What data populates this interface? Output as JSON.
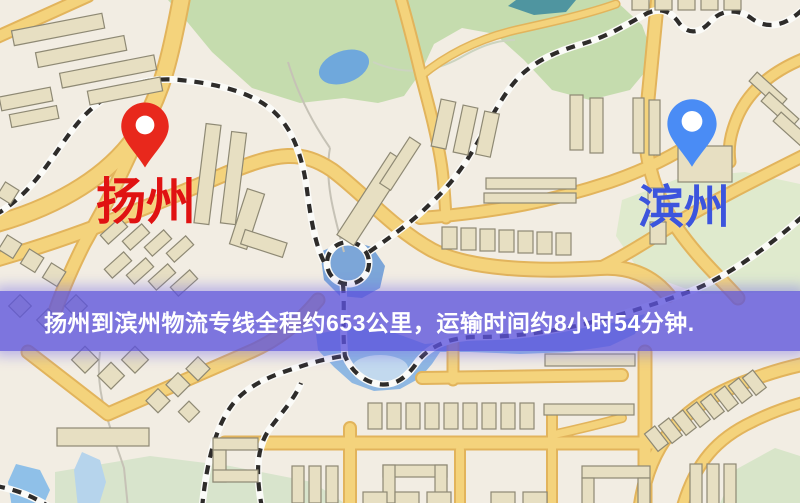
{
  "map": {
    "banner": {
      "text": "扬州到滨州物流专线全程约653公里，运输时间约8小时54分钟.",
      "background": "#5c53dd",
      "text_color": "#ffffff"
    },
    "markers": [
      {
        "id": "yangzhou",
        "label": "扬州",
        "pin_color": "#e8281c",
        "pin_hole": "#ffffff",
        "label_color": "#e01212"
      },
      {
        "id": "binzhou",
        "label": "滨州",
        "pin_color": "#4a8cf5",
        "pin_hole": "#ffffff",
        "label_color": "#3c55dd"
      }
    ],
    "route": {
      "distance_km": "653",
      "duration": "8小时54分钟"
    },
    "palette": {
      "background": "#f2ede3",
      "road_fill": "#f4d37c",
      "road_edge": "#e2b45c",
      "building": "#e7dfc2",
      "building_outline": "#8e8974",
      "park": "#c5dcae",
      "park_pale": "#dfeacd",
      "water": "#8fb8e2",
      "pond": "#6fa8dc",
      "railway": "#2e2c2a"
    }
  }
}
